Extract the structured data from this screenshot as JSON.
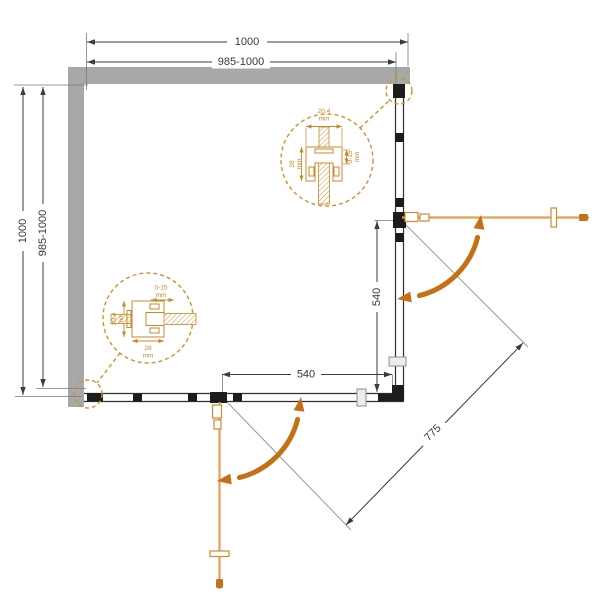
{
  "dimensions": {
    "width_total": "1000",
    "width_adjustable": "985-1000",
    "height_total": "1000",
    "height_adjustable": "985-1000",
    "right_door_opening": "540",
    "bottom_door_opening": "540",
    "diagonal_opening": "775"
  },
  "callouts": {
    "top_right": {
      "profile_width": "20,4",
      "profile_depth": "28",
      "adjustment_range": "0-15",
      "unit": "mm"
    },
    "bottom_left": {
      "profile_width": "20,4",
      "profile_depth": "28",
      "adjustment_range": "0-15",
      "unit": "mm"
    }
  },
  "colors": {
    "wall_fill": "#a8a8a8",
    "line": "#3c3c3c",
    "accent_orange": "#c9882a",
    "door_orange": "#e2a050",
    "arrow_orange": "#c56f16"
  }
}
